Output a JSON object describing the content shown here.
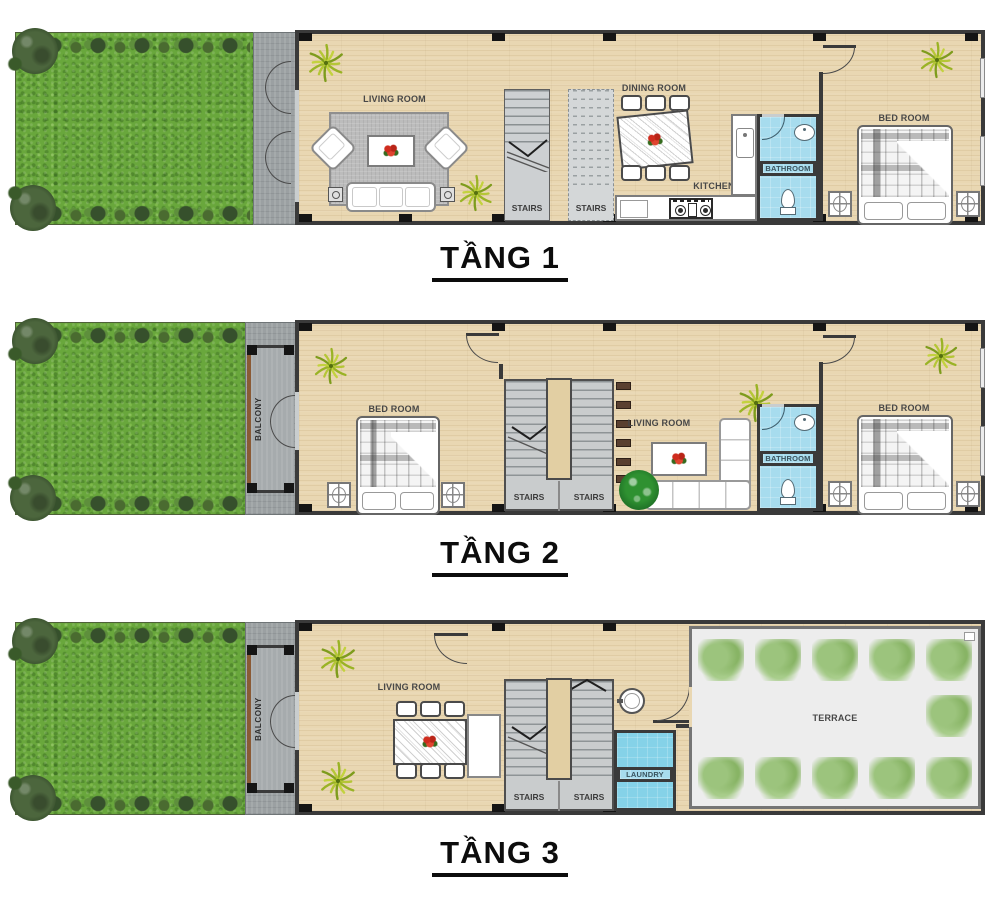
{
  "colors": {
    "grass_green": "#69a73c",
    "wood_floor": "#e9d7b2",
    "wall_dark": "#3a3a3a",
    "pavement_gray": "#9ba0a2",
    "stairs_gray": "#cdd0d2",
    "bathroom_blue": "#a7dcee",
    "laundry_blue": "#85d2e8",
    "terrace_gray": "#ededed",
    "balcony_trim_brown": "#8a5a35",
    "title_black": "#0c0c0c",
    "flower_red": "#cf2c1e"
  },
  "floors": [
    {
      "id": "tang-1",
      "title": "TẦNG 1",
      "labels": {
        "living_room": "LIVING ROOM",
        "stairs_left": "STAIRS",
        "stairs_right": "STAIRS",
        "dining_room": "DINING ROOM",
        "kitchen": "KITCHEN",
        "bathroom": "BATHROOM",
        "bedroom": "BED ROOM"
      }
    },
    {
      "id": "tang-2",
      "title": "TẦNG 2",
      "labels": {
        "balcony": "BALCONY",
        "bedroom_front": "BED ROOM",
        "stairs_left": "STAIRS",
        "stairs_right": "STAIRS",
        "living_room": "LIVING ROOM",
        "bathroom": "BATHROOM",
        "bedroom_back": "BED ROOM"
      }
    },
    {
      "id": "tang-3",
      "title": "TẦNG 3",
      "labels": {
        "balcony": "BALCONY",
        "living_room": "LIVING ROOM",
        "stairs_left": "STAIRS",
        "stairs_right": "STAIRS",
        "laundry": "LAUNDRY",
        "terrace": "TERRACE"
      }
    }
  ]
}
